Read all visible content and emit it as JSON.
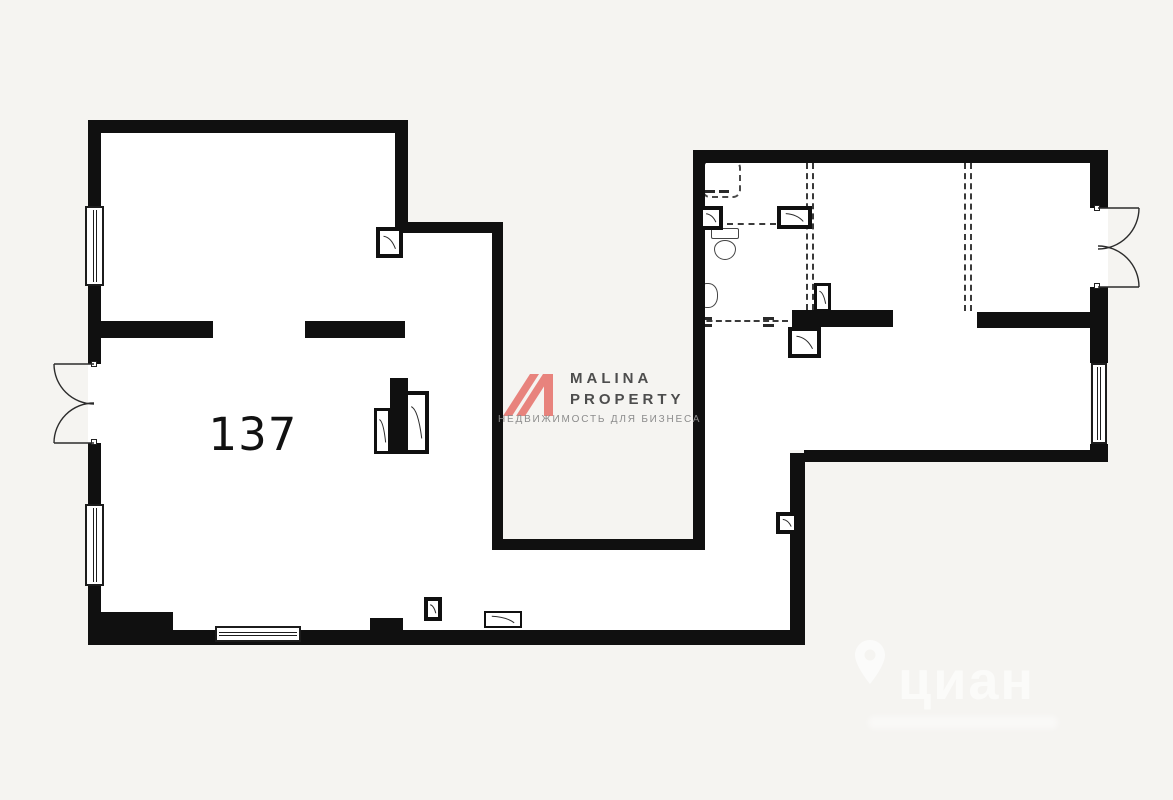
{
  "room": {
    "label": "137"
  },
  "logo": {
    "line1": "MALINA",
    "line2": "PROPERTY",
    "tagline": "НЕДВИЖИМОСТЬ ДЛЯ БИЗНЕСА",
    "mark_polys": [
      "7,46 34,4 43,4 16,46",
      "20,46 47,4 56,4 29,46",
      "48,4 57,4 57,46 48,46"
    ]
  },
  "watermark": {
    "brand": "циан",
    "pin_path": "M18,2 C9.7,2 3,8.7 3,17 C3,28 18,46 18,46 C18,46 33,28 33,17 C33,8.7 26.3,2 18,2 Z M18,11.5 A5.5,5.5 0 1 0 18,22.5 A5.5,5.5 0 1 0 18,11.5 Z"
  },
  "colors": {
    "background": "#f5f4f1",
    "wall": "#101010",
    "line": "#2c2c2c",
    "accent_pink": "#e8837d",
    "logo_text": "#4d4d4d",
    "logo_tagline": "#8c8c8c"
  },
  "plan": {
    "interiors": [
      [
        101,
        133,
        294,
        497
      ],
      [
        395,
        233,
        97,
        397
      ],
      [
        492,
        550,
        313,
        80
      ],
      [
        705,
        163,
        385,
        287
      ],
      [
        705,
        450,
        85,
        100
      ],
      [
        88,
        364,
        13,
        79
      ],
      [
        1090,
        208,
        18,
        79
      ]
    ],
    "walls": [
      [
        88,
        120,
        320,
        13
      ],
      [
        395,
        120,
        13,
        112
      ],
      [
        395,
        222,
        108,
        11
      ],
      [
        492,
        222,
        11,
        328
      ],
      [
        492,
        539,
        213,
        11
      ],
      [
        693,
        150,
        12,
        400
      ],
      [
        693,
        150,
        415,
        13
      ],
      [
        1090,
        152,
        18,
        56
      ],
      [
        1090,
        287,
        18,
        76
      ],
      [
        1090,
        444,
        18,
        18
      ],
      [
        804,
        450,
        304,
        12
      ],
      [
        790,
        453,
        15,
        192
      ],
      [
        88,
        612,
        85,
        33
      ],
      [
        173,
        630,
        632,
        15
      ],
      [
        370,
        618,
        33,
        13
      ],
      [
        88,
        120,
        13,
        86
      ],
      [
        88,
        286,
        13,
        78
      ],
      [
        88,
        443,
        13,
        61
      ],
      [
        88,
        586,
        13,
        44
      ],
      [
        101,
        321,
        112,
        17
      ],
      [
        305,
        321,
        100,
        17
      ],
      [
        390,
        378,
        18,
        76
      ],
      [
        792,
        310,
        101,
        17
      ],
      [
        977,
        312,
        113,
        16
      ]
    ],
    "windows": [
      {
        "x": 85,
        "y": 206,
        "w": 19,
        "h": 80,
        "o": "v"
      },
      {
        "x": 85,
        "y": 504,
        "w": 19,
        "h": 82,
        "o": "v"
      },
      {
        "x": 1091,
        "y": 363,
        "w": 16,
        "h": 81,
        "o": "v"
      },
      {
        "x": 215,
        "y": 626,
        "w": 86,
        "h": 16,
        "o": "h"
      }
    ],
    "boxes": [
      [
        376,
        227,
        27,
        31
      ],
      [
        699,
        206,
        24,
        24
      ],
      [
        777,
        206,
        35,
        23
      ],
      [
        788,
        327,
        33,
        31
      ],
      [
        776,
        512,
        22,
        22
      ],
      [
        424,
        597,
        18,
        24
      ]
    ],
    "panels": [
      {
        "x": 374,
        "y": 408,
        "w": 17,
        "h": 46,
        "b": 3
      },
      {
        "x": 404,
        "y": 391,
        "w": 25,
        "h": 63,
        "b": 4
      },
      {
        "x": 814,
        "y": 283,
        "w": 17,
        "h": 29,
        "b": 3
      },
      {
        "x": 484,
        "y": 611,
        "w": 38,
        "h": 17,
        "b": 2
      }
    ],
    "hinges": [
      [
        91,
        361,
        6,
        6
      ],
      [
        91,
        439,
        6,
        6
      ],
      [
        1094,
        205,
        6,
        6
      ],
      [
        1094,
        283,
        6,
        6
      ]
    ],
    "dash_v": [
      [
        806,
        163,
        8,
        147
      ],
      [
        964,
        163,
        8,
        148
      ]
    ],
    "dash_h": [
      [
        727,
        223,
        49,
        2
      ],
      [
        697,
        320,
        91,
        2
      ]
    ],
    "marks": [
      [
        701,
        317,
        11,
        3
      ],
      [
        701,
        324,
        11,
        3
      ],
      [
        763,
        317,
        11,
        3
      ],
      [
        763,
        324,
        11,
        3
      ],
      [
        705,
        190,
        10,
        3
      ],
      [
        719,
        190,
        10,
        3
      ]
    ],
    "sketch": {
      "appliance": [
        702,
        160,
        39,
        38
      ],
      "toilet_tank": [
        711,
        228,
        28,
        11
      ],
      "toilet_bowl": [
        714,
        240,
        22,
        20
      ],
      "sink": [
        697,
        283,
        21,
        25
      ]
    },
    "door_paths": [
      "M94,364 L54,364",
      "M54,364 A40,40 0 0 0 94,404",
      "M94,443 L54,443",
      "M54,443 A40,40 0 0 1 94,403",
      "M1098,208 L1139,208",
      "M1139,208 A41,41 0 0 1 1098,249",
      "M1098,287 L1139,287",
      "M1139,287 A41,41 0 0 0 1098,246"
    ]
  }
}
